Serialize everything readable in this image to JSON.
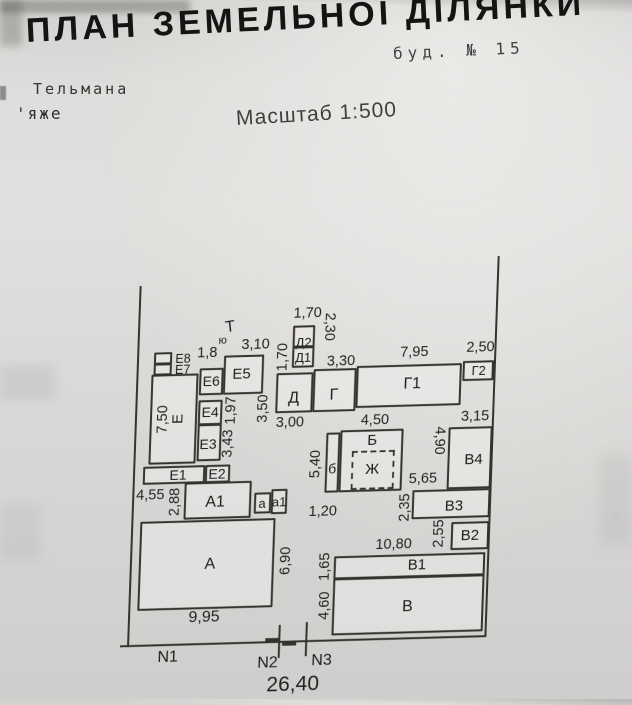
{
  "header": {
    "title": "ПЛАН ЗЕМЕЛЬНОЇ ДІЛЯНКИ",
    "building_number": "буд. №  15",
    "street_name": "Тельмана",
    "street_fragment": "'яже",
    "scale": "Масштаб 1:500"
  },
  "plan": {
    "scale_ratio": "1:500",
    "boundary_markers": {
      "n1": "N1",
      "n2": "N2",
      "n3": "N3"
    },
    "symbols": {
      "t_mark": "Т",
      "yu_mark": "ю"
    },
    "buildings": {
      "A": "А",
      "A1": "А1",
      "a": "а",
      "a1": "а1",
      "B": "Б",
      "b": "б",
      "Zh": "Ж",
      "V": "В",
      "V1": "В1",
      "V2": "В2",
      "V3": "В3",
      "V4": "В4",
      "G": "Г",
      "G1": "Г1",
      "G2": "Г2",
      "D": "Д",
      "D1": "Д1",
      "D2": "Д2",
      "E": "Е",
      "E1": "Е1",
      "E2": "Е2",
      "E3": "Е3",
      "E4": "Е4",
      "E5": "Е5",
      "E6": "Е6",
      "E7": "Е7",
      "E8": "Е8"
    },
    "dimensions": {
      "d18": "1,8",
      "d310": "3,10",
      "d170": "1,70",
      "d230": "2,30",
      "d330": "3,30",
      "d795": "7,95",
      "d250": "2,50",
      "d750": "7,50",
      "d197": "1,97",
      "d343": "3,43",
      "d350": "3,50",
      "d300": "3,00",
      "d450": "4,50",
      "d315": "3,15",
      "d490": "4,90",
      "d540": "5,40",
      "d565": "5,65",
      "d235": "2,35",
      "d255": "2,55",
      "d1080": "10,80",
      "d165": "1,65",
      "d460": "4,60",
      "d120": "1,20",
      "d455": "4,55",
      "d288": "2,88",
      "d690": "6,90",
      "d995": "9,95",
      "d2640": "26,40"
    }
  }
}
